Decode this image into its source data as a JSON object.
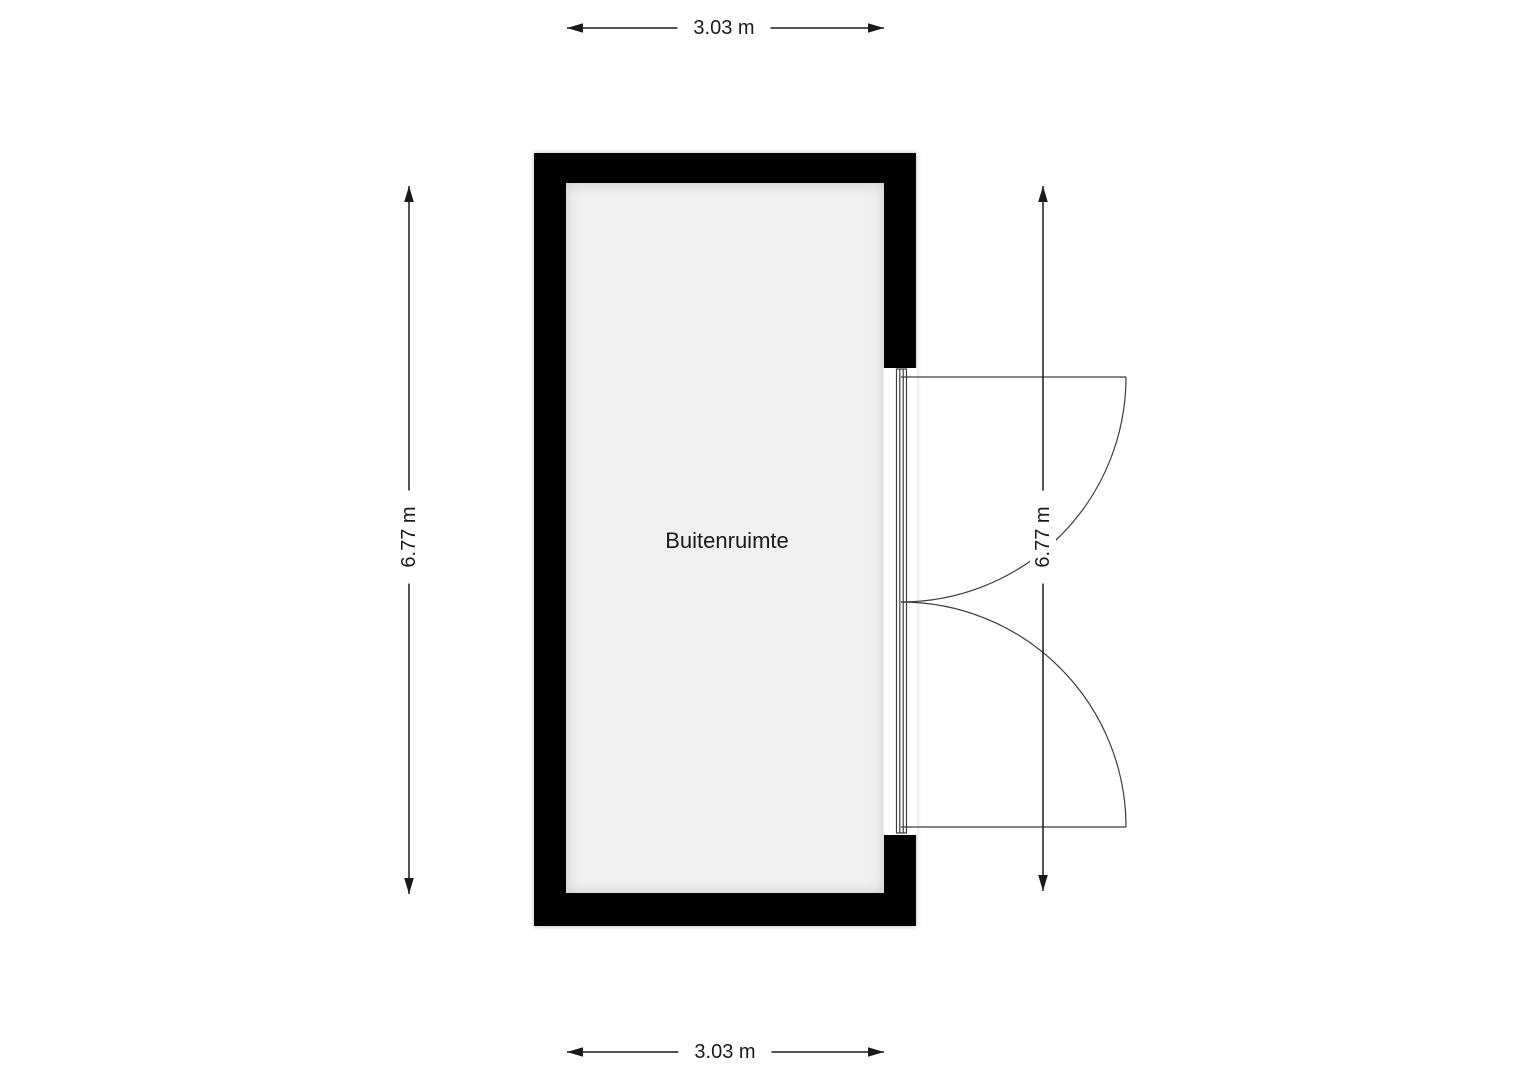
{
  "floorplan": {
    "room": {
      "name": "Buitenruimte",
      "width_label": "3.03 m",
      "height_label": "6.77 m"
    },
    "dimensions": {
      "top": "3.03 m",
      "bottom": "3.03 m",
      "left": "6.77 m",
      "right": "6.77 m"
    },
    "colors": {
      "background": "#ffffff",
      "wall": "#000000",
      "floor": "#f0f0f0",
      "line": "#3d3d3d",
      "dimension": "#1a1a1a",
      "text": "#1a1a1a"
    }
  }
}
